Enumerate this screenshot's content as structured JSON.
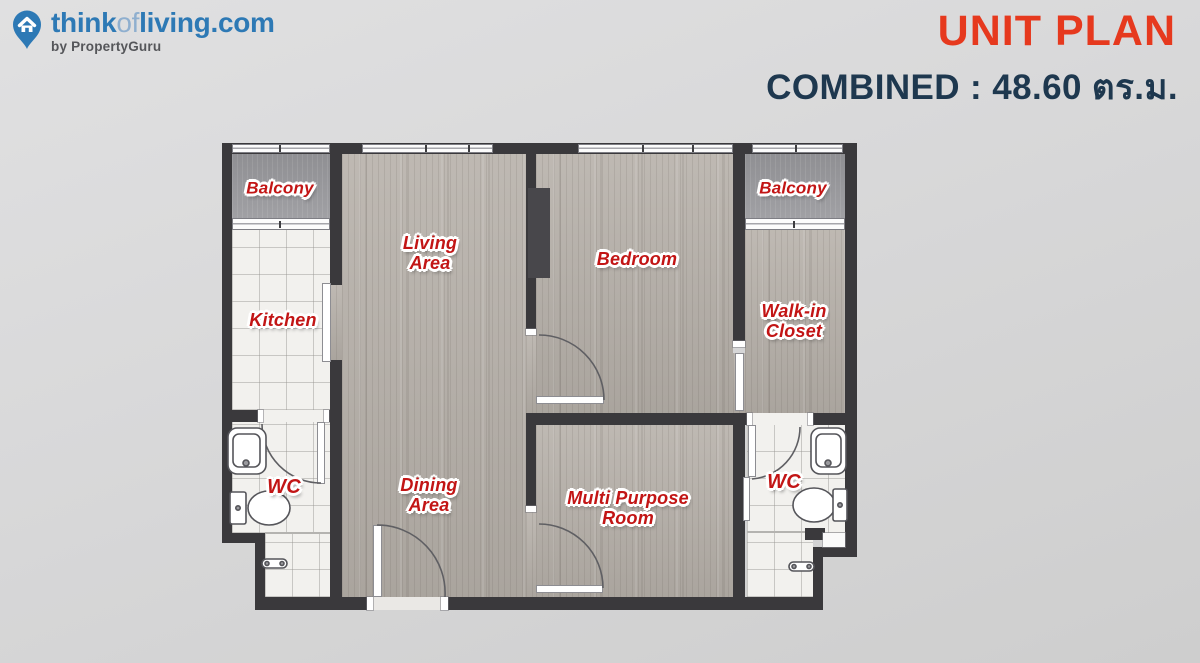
{
  "header": {
    "logo": {
      "icon": "map-pin-house-icon",
      "brand_think": "think",
      "brand_of": "of",
      "brand_living": "living",
      "brand_dotcom": ".com",
      "byline": "by PropertyGuru"
    },
    "title": "UNIT PLAN",
    "subtitle": "COMBINED : 48.60 ตร.ม."
  },
  "colors": {
    "brand_blue": "#2d79b5",
    "brand_light_blue": "#8fafcf",
    "title_red": "#e6391e",
    "subtitle_navy": "#1e384f",
    "room_label_red": "#c21515",
    "wall_dark": "#3a393c"
  },
  "floorplan": {
    "rooms": {
      "balcony_left": {
        "lines": [
          "Balcony"
        ]
      },
      "kitchen": {
        "lines": [
          "Kitchen"
        ]
      },
      "wc_left": {
        "lines": [
          "WC"
        ]
      },
      "living_area": {
        "lines": [
          "Living",
          "Area"
        ]
      },
      "dining_area": {
        "lines": [
          "Dining",
          "Area"
        ]
      },
      "bedroom": {
        "lines": [
          "Bedroom"
        ]
      },
      "multi_purpose_room": {
        "lines": [
          "Multi Purpose",
          "Room"
        ]
      },
      "balcony_right": {
        "lines": [
          "Balcony"
        ]
      },
      "walk_in_closet": {
        "lines": [
          "Walk-in",
          "Closet"
        ]
      },
      "wc_right": {
        "lines": [
          "WC"
        ]
      }
    }
  }
}
